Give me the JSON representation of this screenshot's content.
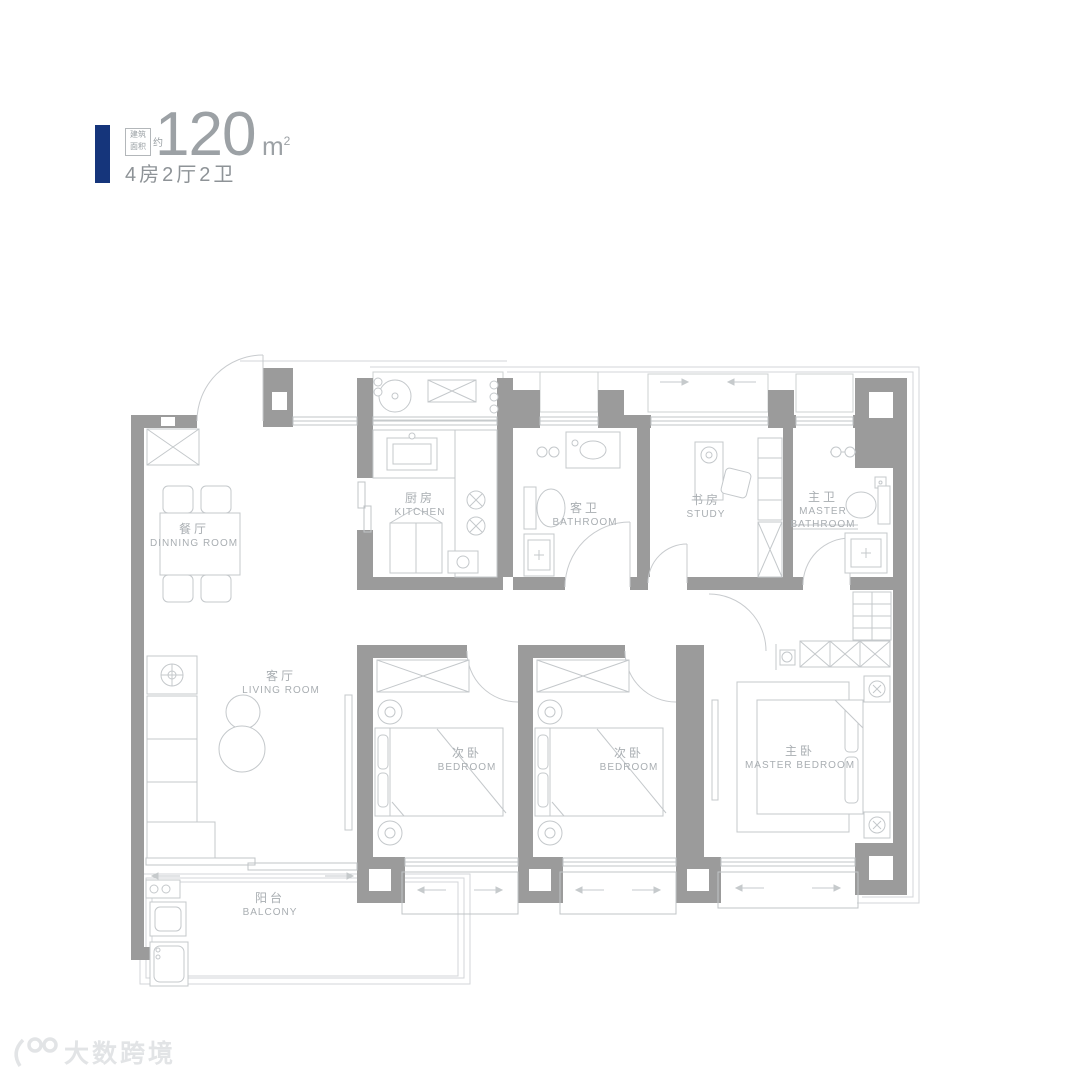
{
  "header": {
    "area_prefix_line1": "建筑",
    "area_prefix_line2": "面积",
    "approx": "约",
    "area_value": "120",
    "area_unit": "m",
    "area_unit_sup": "2",
    "layout_spec": "4房2厅2卫"
  },
  "rooms": {
    "dining": {
      "zh": "餐厅",
      "en": "DINNING ROOM"
    },
    "kitchen": {
      "zh": "厨房",
      "en": "KITCHEN"
    },
    "guest_bath": {
      "zh": "客卫",
      "en": "BATHROOM"
    },
    "study": {
      "zh": "书房",
      "en": "STUDY"
    },
    "master_bath": {
      "zh": "主卫",
      "en": "MASTER BATHROOM"
    },
    "living": {
      "zh": "客厅",
      "en": "LIVING ROOM"
    },
    "bedroom_a": {
      "zh": "次卧",
      "en": "BEDROOM"
    },
    "bedroom_b": {
      "zh": "次卧",
      "en": "BEDROOM"
    },
    "master_bedroom": {
      "zh": "主卧",
      "en": "MASTER BEDROOM"
    },
    "balcony": {
      "zh": "阳台",
      "en": "BALCONY"
    }
  },
  "watermark": {
    "text": "大数跨境"
  },
  "colors": {
    "wall": "#9b9b9b",
    "line": "#c7cbce",
    "label": "#a9aeb2",
    "accent_blue": "#15357b"
  }
}
